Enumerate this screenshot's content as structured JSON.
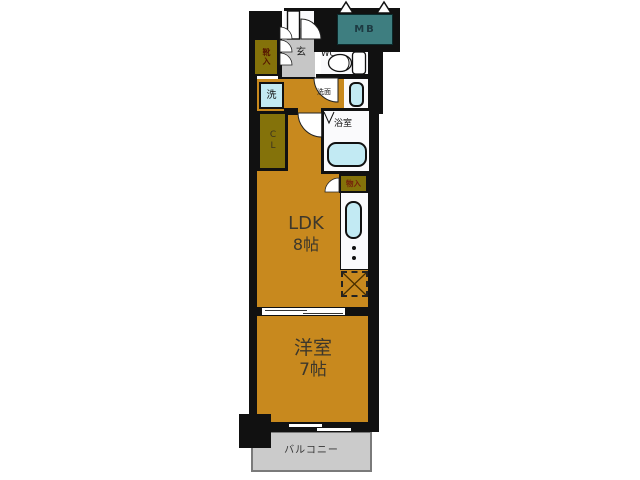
{
  "floor_plan": {
    "rooms": {
      "ldk": {
        "name": "LDK",
        "size": "8帖"
      },
      "western_room": {
        "name": "洋室",
        "size": "7帖"
      },
      "balcony": {
        "name": "バルコニー"
      },
      "entrance": {
        "name": "玄"
      },
      "shoe_cabinet": {
        "name": "靴入"
      },
      "closet": {
        "name": "CL"
      },
      "storage": {
        "name": "物入"
      },
      "toilet": {
        "name": "WC"
      },
      "bathroom": {
        "name": "浴室"
      },
      "laundry": {
        "name": "洗"
      },
      "washroom": {
        "name": "洗面"
      },
      "meter_box": {
        "name": "MB"
      }
    },
    "colors": {
      "room_floor": "#C8891E",
      "storage_fill": "#84720A",
      "meter_box_fill": "#3E7E80",
      "fixture_fill": "#C2EAF3",
      "entrance_floor": "#C6C6C6",
      "balcony_floor": "#CBCBCB",
      "wall": "#111111"
    }
  }
}
